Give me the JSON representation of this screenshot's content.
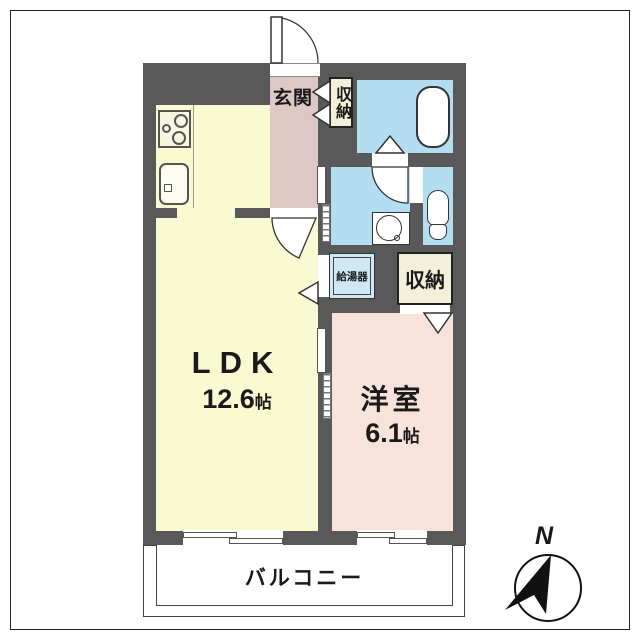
{
  "floorplan": {
    "entrance": {
      "label": "玄関"
    },
    "storage_top": {
      "label": "収納"
    },
    "storage_lower": {
      "label": "収納"
    },
    "water_heater": {
      "label": "給湯器"
    },
    "ldk": {
      "name": "LDK",
      "size": "12.6",
      "unit": "帖"
    },
    "western_room": {
      "name": "洋室",
      "size": "6.1",
      "unit": "帖"
    },
    "balcony": {
      "label": "バルコニー"
    },
    "compass": {
      "north_label": "N"
    },
    "colors": {
      "wall": "#595959",
      "ldk_floor": "#fafad2",
      "hallway_floor": "#ddc8c5",
      "western_room_floor": "#f8e3da",
      "wet_area_floor": "#b3def2",
      "storage_floor": "#f3f0d9",
      "water_heater_box": "#cfe8f4"
    },
    "fixtures": [
      "stove-icon",
      "sink-icon",
      "bathtub-icon",
      "washbasin-icon",
      "toilet-icon",
      "north-arrow-icon"
    ]
  }
}
